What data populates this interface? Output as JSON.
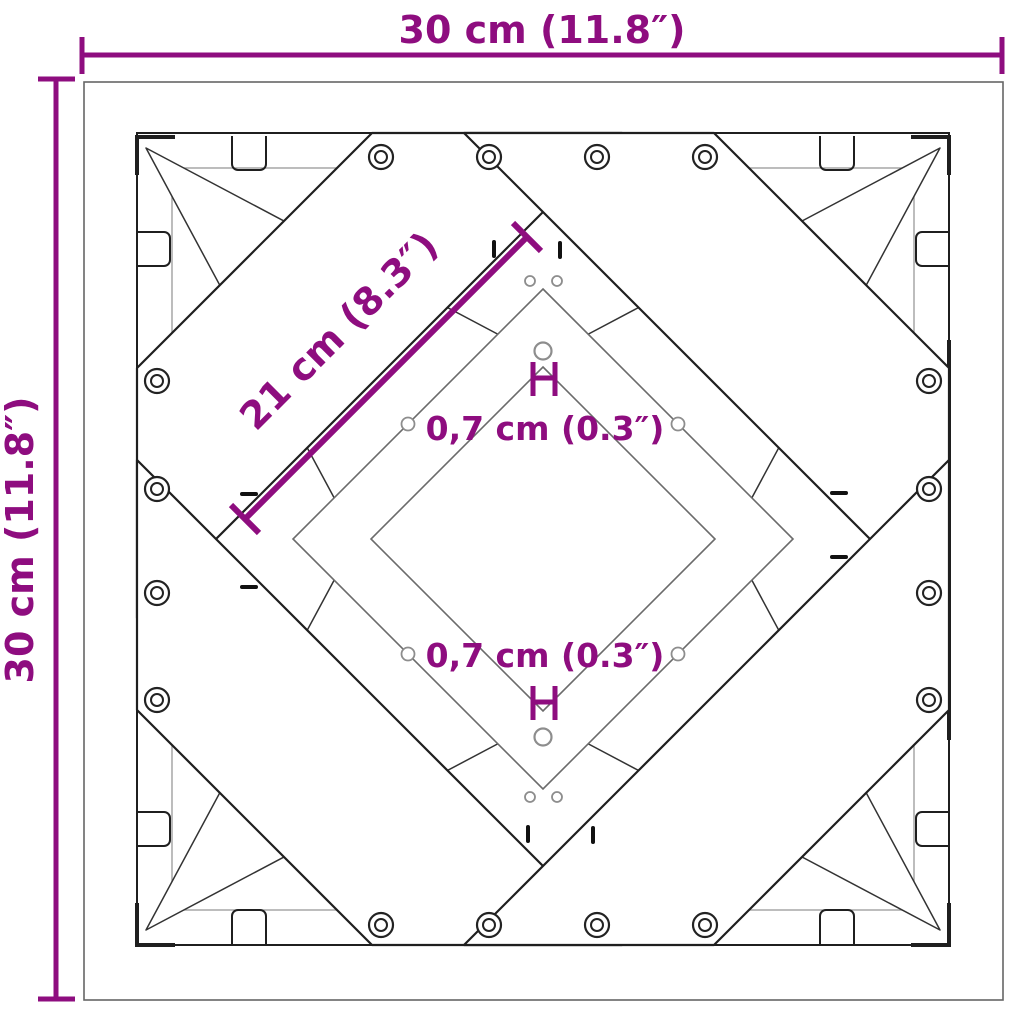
{
  "diagram": {
    "background": "#ffffff",
    "subject": "Square cross-frame table base, top view technical dimension drawing",
    "colors": {
      "dimension_accent": "#8E0D7F",
      "line_dark": "#1f1f1f",
      "line_mid": "#666666",
      "line_light": "#999999"
    },
    "dimensions": {
      "top": "30 cm (11.8″)",
      "left": "30 cm (11.8″)",
      "diagonal": "21 cm (8.3″)",
      "hole_top": "0,7 cm (0.3″)",
      "hole_bottom": "0,7 cm (0.3″)"
    }
  }
}
